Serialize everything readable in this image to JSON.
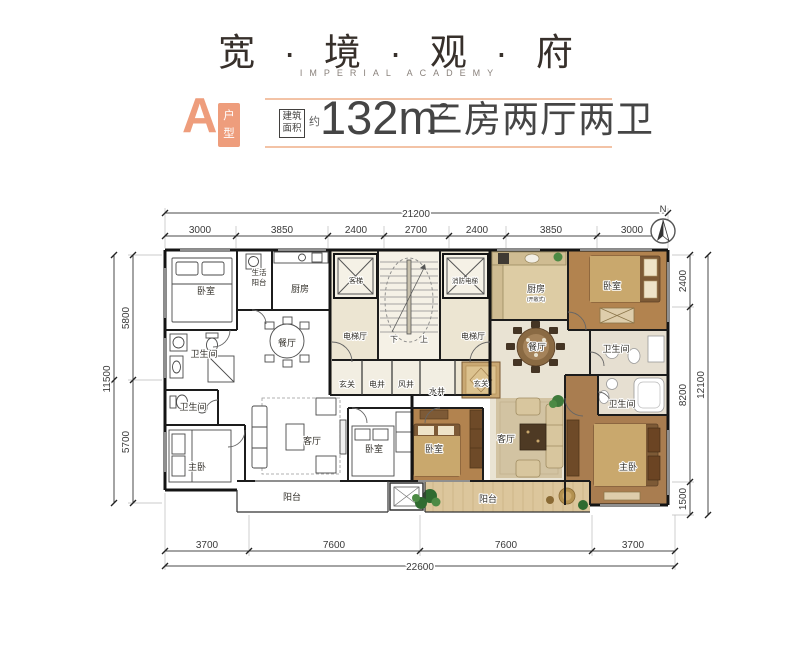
{
  "header": {
    "title": "宽 · 境 · 观 · 府",
    "subtitle": "IMPERIAL ACADEMY"
  },
  "unit": {
    "letter": "A",
    "type_label": "户型",
    "area_box_label": "建筑面积",
    "approx": "约",
    "area_value": "132m",
    "area_exponent": "2",
    "description": "三房两厅两卫"
  },
  "compass": {
    "north": "N"
  },
  "dims": {
    "top": {
      "total": "21200",
      "segments": [
        "3000",
        "3850",
        "2400",
        "2700",
        "2400",
        "3850",
        "3000"
      ]
    },
    "bottom": {
      "total": "22600",
      "segments": [
        "3700",
        "7600",
        "7600",
        "3700"
      ]
    },
    "left": {
      "total": "11500",
      "segments": [
        "5800",
        "5700"
      ]
    },
    "right": {
      "total": "12100",
      "segments": [
        "2400",
        "8200",
        "1500"
      ]
    }
  },
  "rooms": {
    "l_bedroom1": "卧室",
    "l_life_balcony_1": "生活",
    "l_life_balcony_2": "阳台",
    "l_kitchen": "厨房",
    "l_dining": "餐厅",
    "l_bath1": "卫生间",
    "l_bath2": "卫生间",
    "l_master": "主卧",
    "l_living": "客厅",
    "l_bedroom2": "卧室",
    "l_balcony": "阳台",
    "l_foyer": "玄关",
    "l_lift_hall": "电梯厅",
    "core_lift": "客梯",
    "core_fire_lift": "消防电梯",
    "stair_down": "下",
    "stair_up": "上",
    "shaft_elec": "电井",
    "shaft_wind": "风井",
    "shaft_water": "水井",
    "r_kitchen": "厨房",
    "r_kitchen_note": "(开敞式)",
    "r_bedroom1": "卧室",
    "r_dining": "餐厅",
    "r_bath1": "卫生间",
    "r_foyer": "玄关",
    "r_lift_hall": "电梯厅",
    "r_living": "客厅",
    "r_bedroom2": "卧室",
    "r_bath2": "卫生间",
    "r_master": "主卧",
    "r_balcony": "阳台"
  },
  "colors": {
    "accent_salmon": "#ee9d7c",
    "divider_peach": "#f3c3a6",
    "title_ink": "#37302b",
    "wall_black": "#141414",
    "core_beige": "#ece5d2",
    "tile_beige": "#e9e3d3",
    "wood_floor": "#b2834f",
    "furniture_wood": "#7d5a36",
    "blanket_tan": "#c9a86d",
    "balcony_wood": "#dcc69c"
  }
}
